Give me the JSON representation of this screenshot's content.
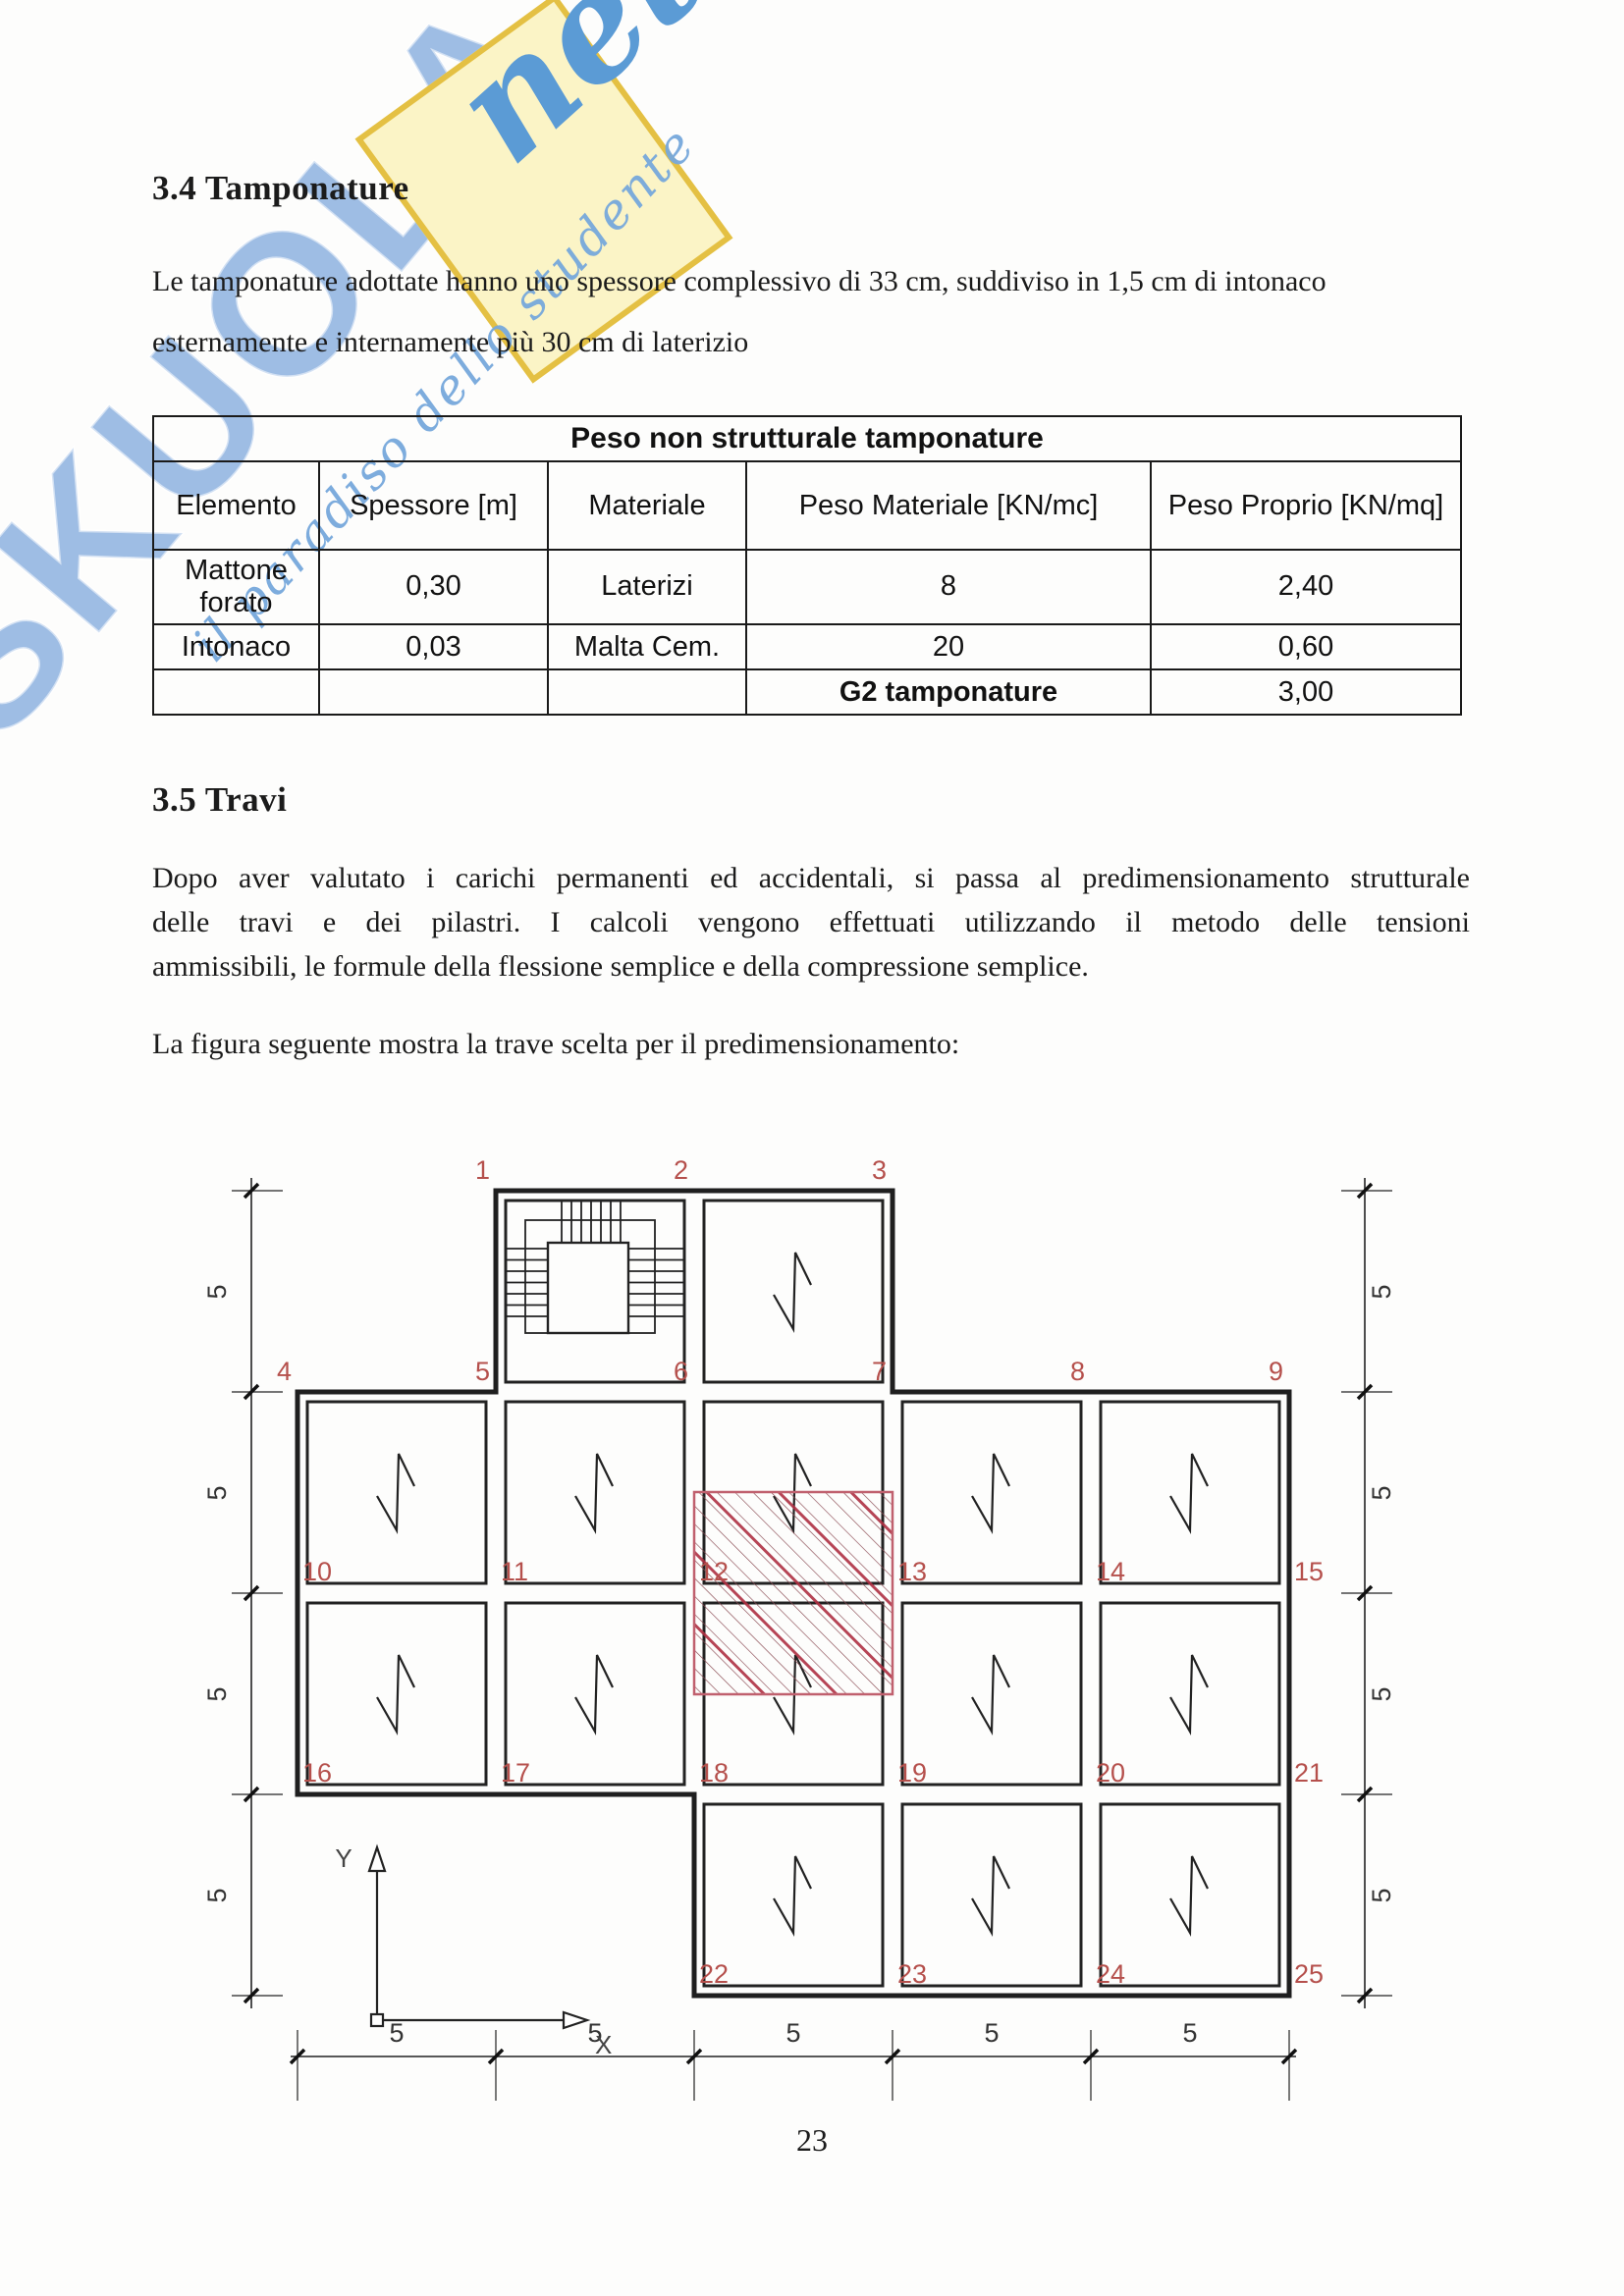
{
  "watermark": {
    "brand": "SKUOLA",
    "net": "net",
    "tagline": "il paradiso dello studente",
    "yellow": "#fbf4c6",
    "blue": "#5b9bd5",
    "light_blue": "#86addd"
  },
  "section_tamponature": {
    "heading": "3.4 Tamponature",
    "line1": "Le tamponature adottate hanno uno spessore complessivo di 33 cm, suddiviso in 1,5 cm di intonaco",
    "line2": "esternamente e internamente più 30 cm di laterizio"
  },
  "table": {
    "title": "Peso non strutturale tamponature",
    "headers": [
      "Elemento",
      "Spessore [m]",
      "Materiale",
      "Peso Materiale [KN/mc]",
      "Peso Proprio [KN/mq]"
    ],
    "rows": [
      [
        "Mattone forato",
        "0,30",
        "Laterizi",
        "8",
        "2,40"
      ],
      [
        "Intonaco",
        "0,03",
        "Malta Cem.",
        "20",
        "0,60"
      ]
    ],
    "total_label": "G2 tamponature",
    "total_value": "3,00"
  },
  "section_travi": {
    "heading": "3.5 Travi",
    "para": [
      "Dopo aver valutato i carichi permanenti ed accidentali, si passa al predimensionamento strutturale",
      "delle travi e dei pilastri.  I calcoli vengono effettuati utilizzando il metodo delle tensioni",
      "ammissibili, le formule della flessione semplice e della compressione semplice."
    ],
    "caption": "La figura seguente mostra la trave scelta per il predimensionamento:"
  },
  "figure": {
    "point_labels": [
      "1",
      "2",
      "3",
      "4",
      "5",
      "6",
      "7",
      "8",
      "9",
      "10",
      "11",
      "12",
      "13",
      "14",
      "15",
      "16",
      "17",
      "18",
      "19",
      "20",
      "21",
      "22",
      "23",
      "24",
      "25"
    ],
    "dim_left": [
      "5",
      "5",
      "5",
      "5"
    ],
    "dim_right": [
      "5",
      "5",
      "5",
      "5"
    ],
    "dim_bottom": [
      "5",
      "5",
      "5",
      "5",
      "5"
    ],
    "axis_x": "X",
    "axis_y": "Y",
    "accent_red": "#b5504c",
    "hatch_red": "#ae2f42"
  },
  "page": {
    "number": "23"
  }
}
